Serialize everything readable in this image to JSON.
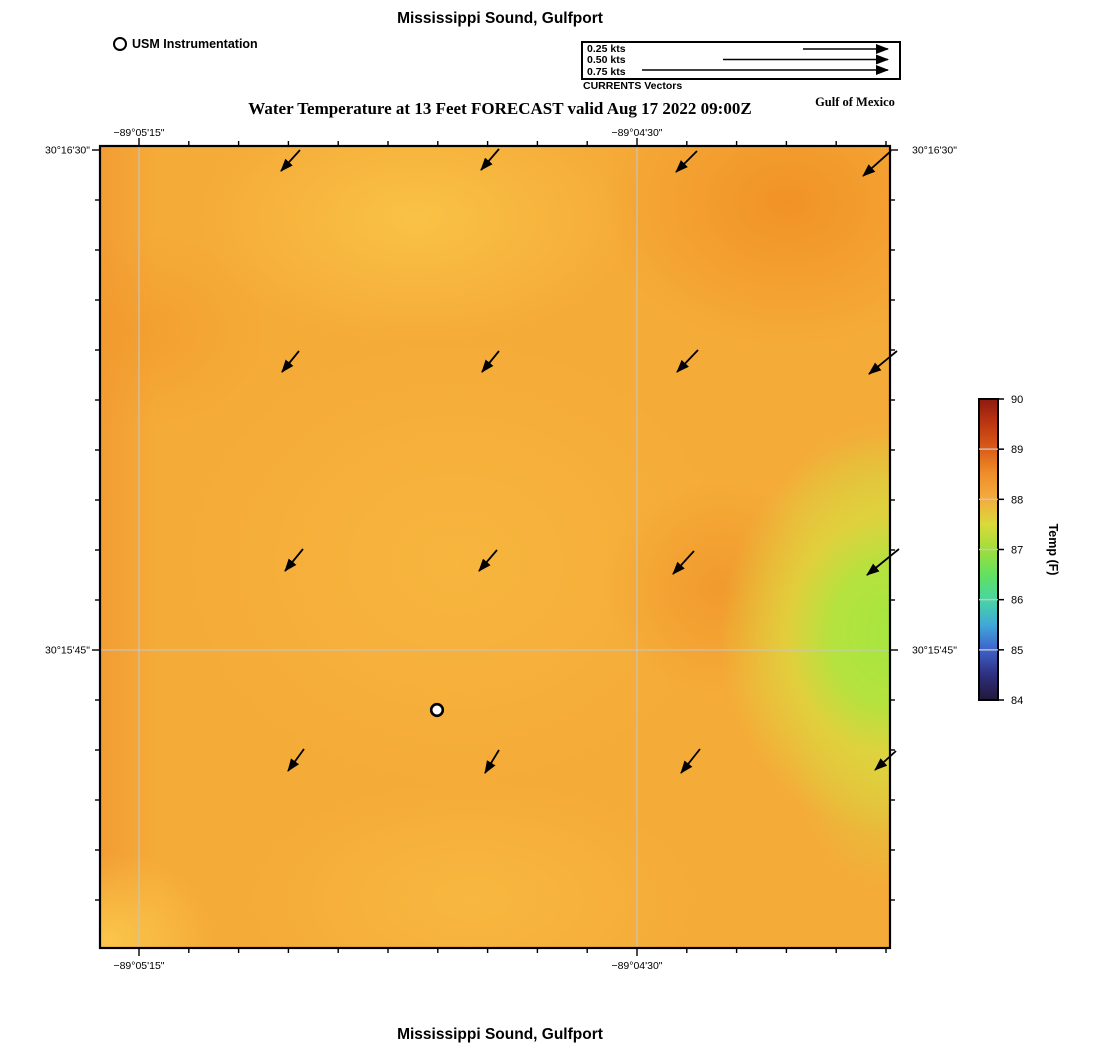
{
  "header": {
    "top_title": "Mississippi Sound, Gulfport",
    "subtitle": "Water Temperature at 13 Feet FORECAST valid Aug 17 2022 09:00Z",
    "gulf_label": "Gulf of Mexico",
    "station_legend_label": "USM Instrumentation",
    "vector_legend": {
      "caption": "CURRENTS Vectors",
      "items": [
        {
          "label": "0.25 kts",
          "line_start_x": 803
        },
        {
          "label": "0.50 kts",
          "line_start_x": 723
        },
        {
          "label": "0.75 kts",
          "line_start_x": 642
        }
      ],
      "line_end_x": 888,
      "line_ys": [
        49,
        59.5,
        70
      ]
    }
  },
  "footer": {
    "bottom_title": "Mississippi Sound, Gulfport"
  },
  "chart_data": {
    "type": "heatmap",
    "title": "Mississippi Sound, Gulfport",
    "subtitle": "Water Temperature at 13 Feet FORECAST valid Aug 17 2022 09:00Z",
    "plot_area": {
      "x": 100,
      "y": 146,
      "width": 790,
      "height": 802
    },
    "x_axis": {
      "ticks": [
        {
          "label": "−89°05'15\"",
          "x": 139
        },
        {
          "label": "−89°04'30\"",
          "x": 637
        }
      ],
      "minor_tick_start": 139,
      "minor_tick_spacing": 49.8,
      "minor_tick_count": 16
    },
    "y_axis": {
      "ticks": [
        {
          "label": "30°16'30\"",
          "y": 150
        },
        {
          "label": "30°15'45\"",
          "y": 650
        }
      ],
      "minor_tick_start": 150,
      "minor_tick_spacing": 50,
      "minor_tick_count": 16
    },
    "gridlines": {
      "x": [
        139,
        637
      ],
      "y": [
        650
      ]
    },
    "temperature_field": {
      "units": "F",
      "colorbar_range": [
        84,
        90
      ],
      "approx_background_value_f": 88,
      "notes_regions": [
        {
          "area": "most of map",
          "approx_value_f": 88,
          "color": "#f5ab38"
        },
        {
          "area": "right edge mid (cool green patch)",
          "approx_value_f": 87,
          "color": "#a7e63f"
        },
        {
          "area": "top-right / scattered warm patches",
          "approx_value_f": 88.5,
          "color": "#f08c22"
        }
      ]
    },
    "current_vectors": {
      "units": "kts",
      "direction": "southwest",
      "arrows": [
        [
          300,
          150,
          281,
          171
        ],
        [
          499,
          149,
          481,
          170
        ],
        [
          697,
          151,
          676,
          172
        ],
        [
          891,
          151,
          863,
          176
        ],
        [
          299,
          351,
          282,
          372
        ],
        [
          499,
          351,
          482,
          372
        ],
        [
          698,
          350,
          677,
          372
        ],
        [
          897,
          351,
          869,
          374
        ],
        [
          303,
          549,
          285,
          571
        ],
        [
          497,
          550,
          479,
          571
        ],
        [
          694,
          551,
          673,
          574
        ],
        [
          899,
          549,
          867,
          575
        ],
        [
          304,
          749,
          288,
          771
        ],
        [
          499,
          750,
          485,
          773
        ],
        [
          700,
          749,
          681,
          773
        ],
        [
          896,
          751,
          875,
          770
        ]
      ]
    },
    "station": {
      "x": 437,
      "y": 710,
      "label": "USM Instrumentation"
    },
    "colorbar": {
      "label": "Temp (F)",
      "x": 979,
      "y_top": 399,
      "y_bottom": 700,
      "width": 19,
      "tick_values": [
        84,
        85,
        86,
        87,
        88,
        89,
        90
      ],
      "stops": [
        {
          "pos": 0.0,
          "color": "#211838"
        },
        {
          "pos": 0.083,
          "color": "#2e2f7e"
        },
        {
          "pos": 0.167,
          "color": "#3e62cb"
        },
        {
          "pos": 0.25,
          "color": "#41a8d8"
        },
        {
          "pos": 0.333,
          "color": "#47d6a2"
        },
        {
          "pos": 0.417,
          "color": "#63e05f"
        },
        {
          "pos": 0.5,
          "color": "#9fde3b"
        },
        {
          "pos": 0.583,
          "color": "#d9da3b"
        },
        {
          "pos": 0.667,
          "color": "#f4ac3d"
        },
        {
          "pos": 0.75,
          "color": "#ef8f2a"
        },
        {
          "pos": 0.833,
          "color": "#db5d18"
        },
        {
          "pos": 0.917,
          "color": "#be3711"
        },
        {
          "pos": 1.0,
          "color": "#8e1a10"
        }
      ]
    }
  }
}
